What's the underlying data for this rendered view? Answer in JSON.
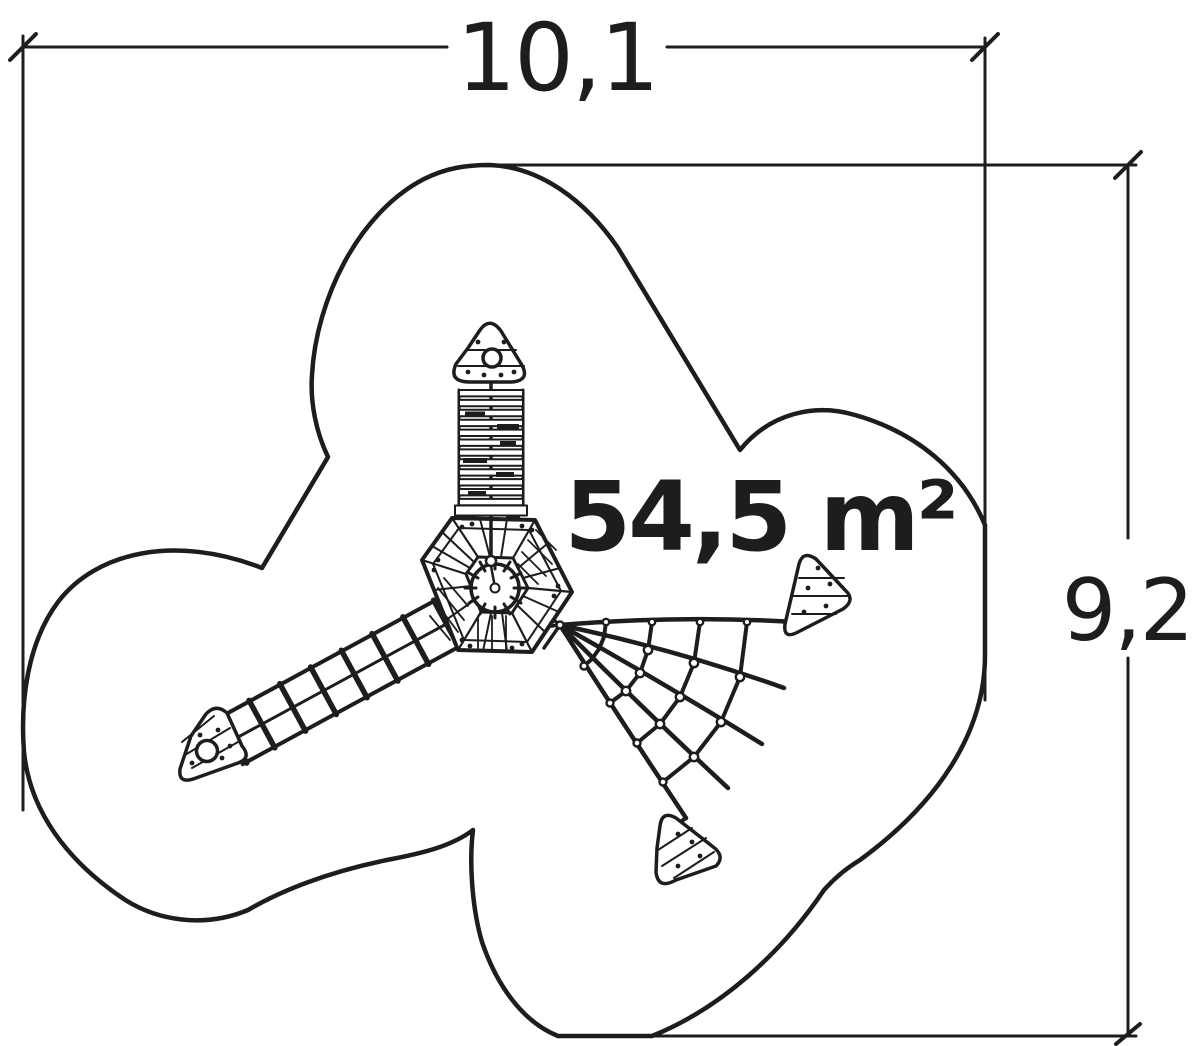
{
  "labels": {
    "width_dimension": "10,1",
    "height_dimension": "9,2",
    "area": "54,5 m²"
  },
  "colors": {
    "ink": "#1d1d1b",
    "paper": "#ffffff"
  }
}
